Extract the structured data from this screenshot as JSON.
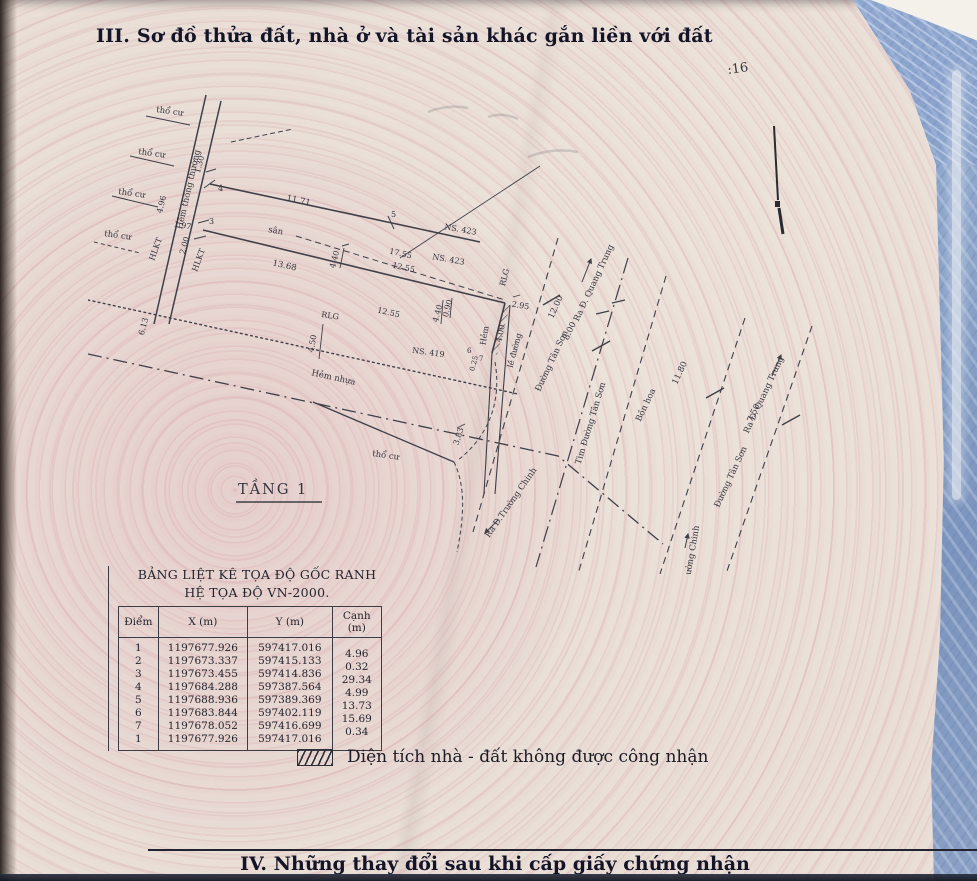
{
  "page": {
    "title_section3": "III. Sơ đồ thửa đất, nhà ở và tài sản khác gắn liền với đất",
    "title_section4": "IV. Những thay đổi sau khi cấp giấy chứng nhận",
    "stamp": ":16"
  },
  "legend": {
    "hatch_label": "Diện tích nhà - đất không được công nhận"
  },
  "coord_table": {
    "title_line1": "BẢNG LIỆT KÊ TỌA ĐỘ GỐC RANH",
    "title_line2": "HỆ TỌA ĐỘ VN-2000.",
    "headers": {
      "point": "Điểm",
      "x": "X (m)",
      "y": "Y (m)",
      "edge": "Cạnh (m)"
    },
    "rows": [
      {
        "p": "1",
        "x": "1197677.926",
        "y": "597417.016",
        "edge": ""
      },
      {
        "p": "2",
        "x": "1197673.337",
        "y": "597415.133",
        "edge": "4.96"
      },
      {
        "p": "3",
        "x": "1197673.455",
        "y": "597414.836",
        "edge": "0.32"
      },
      {
        "p": "4",
        "x": "1197684.288",
        "y": "597387.564",
        "edge": "29.34"
      },
      {
        "p": "5",
        "x": "1197688.936",
        "y": "597389.369",
        "edge": "4.99"
      },
      {
        "p": "6",
        "x": "1197683.844",
        "y": "597402.119",
        "edge": "13.73"
      },
      {
        "p": "7",
        "x": "1197678.052",
        "y": "597416.699",
        "edge": "15.69"
      },
      {
        "p": "1",
        "x": "1197677.926",
        "y": "597417.016",
        "edge": "0.34"
      }
    ]
  },
  "diagram": {
    "floor": "TẦNG 1",
    "land_use": "thổ cư",
    "yard": "sân",
    "alley_main": "Hẻm thông thường",
    "alley_asphalt": "Hẻm nhựa",
    "alley_small": "Hẻm",
    "curb": "lề đường",
    "rlg": "RLG",
    "hlkt": "HLKT",
    "house_423": "NS. 423",
    "house_419": "NS. 419",
    "road_tan_son": "Đường Tân Sơn",
    "road_tan_son_center": "Tim Đường Tân Sơn",
    "flower_bed": "Bồn hoa",
    "to_quang_trung": "Ra Đ. Quang Trung",
    "to_truong_chinh": "Ra Đ.Trường Chinh",
    "points": {
      "p3": "3",
      "p4": "4",
      "p5": "5",
      "p6": "6",
      "p7": "7"
    },
    "dims": {
      "d1171": "11.71",
      "d1368": "13.68",
      "d1755": "17.55",
      "d1255": "12.55",
      "d496": "4.96",
      "d130": "1.30",
      "d197": "1.97",
      "d200": "2.00",
      "d613": "6.13",
      "d450": "4.50",
      "d440": "4.40",
      "d090": "0.90",
      "d400": "4.00",
      "d295": "2.95",
      "d383": "3.83",
      "d025": "0.25",
      "d1200": "12.00",
      "d800": "8.00",
      "d1180": "11.80",
      "d750": "7.50"
    }
  },
  "colors": {
    "paper": "#e9dfd6",
    "ink": "#2c2c36",
    "blue_bg": "#8fa6c7",
    "pattern_pink": "#d8aab2"
  }
}
